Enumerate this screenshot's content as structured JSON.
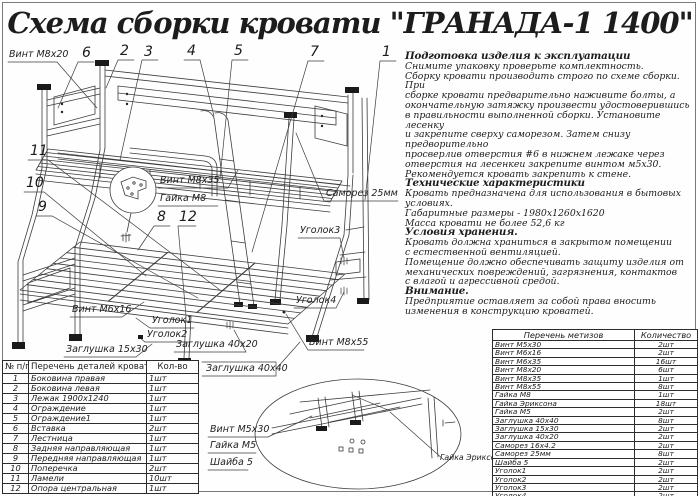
{
  "title": "Схема сборки кровати \"ГРАНАДА-1 1400\"",
  "instructions": {
    "items": [
      {
        "style": "h",
        "text": "Подготовка изделия к эксплуатации"
      },
      {
        "style": "p",
        "text": "Снимите упаковку проверьте комплектность."
      },
      {
        "style": "p",
        "text": "Сборку кровати производить строго по схеме сборки. При"
      },
      {
        "style": "p",
        "text": "сборке кровати  предварительно наживите  болты, а"
      },
      {
        "style": "p",
        "text": "окончательную затяжку произвести удостоверившись"
      },
      {
        "style": "p",
        "text": "в правильности выполненной сборки. Установите лесенку"
      },
      {
        "style": "p",
        "text": "и закрепите сверху саморезом. Затем снизу предворительно"
      },
      {
        "style": "p",
        "text": "просверлив отверстия #6 в нижнем лежаке через"
      },
      {
        "style": "p",
        "text": "отверстия на лесенкеи закрепите винтом м5х30."
      },
      {
        "style": "p",
        "text": "Рекомендуется кровать закрепить к стене."
      },
      {
        "style": "h",
        "text": "Технические характеристики"
      },
      {
        "style": "p",
        "text": "Кровать предназначена для использования в бытовых"
      },
      {
        "style": "p",
        "text": "условиях."
      },
      {
        "style": "p",
        "text": "Габаритные размеры - 1980х1260х1620"
      },
      {
        "style": "p",
        "text": "Масса кровати не более 52,6 кг"
      },
      {
        "style": "h",
        "text": "Условия хранения."
      },
      {
        "style": "p",
        "text": "Кровать должна храниться в закрытом помещении"
      },
      {
        "style": "p",
        "text": "с естественной вентиляцией."
      },
      {
        "style": "p",
        "text": "Помещение должно обеспечивать защиту изделия от"
      },
      {
        "style": "p",
        "text": "механических повреждений, загрязнения, контактов"
      },
      {
        "style": "p",
        "text": "с влагой и агрессивной средой."
      },
      {
        "style": "h",
        "text": "Внимание."
      },
      {
        "style": "p",
        "text": "Предприятие оставляет за собой права вносить"
      },
      {
        "style": "p",
        "text": "изменения в конструкцию кроватей."
      }
    ]
  },
  "diagram": {
    "labels": {
      "vint_m8x20": "Винт М8х20",
      "vint_m8x35": "Винт М8х35",
      "gaika_m8": "Гайка М8",
      "samorez_25": "Саморез 25мм",
      "ugolok3": "Уголок3",
      "ugolok4": "Уголок4",
      "vint_m8x55": "Винт М8х55",
      "vint_m6x16": "Винт М6х16",
      "ugolok1": "Уголок1",
      "ugolok2": "Уголок2",
      "zaglushka_15x30": "Заглушка 15х30",
      "zaglushka_40x20": "Заглушка 40х20",
      "zaglushka_40x40": "Заглушка 40х40",
      "vint_m5x30": "Винт М5х30",
      "gaika_m5": "Гайка М5",
      "shaiba_5": "Шайба 5",
      "gaika_eriksona": "Гайка Эриксона"
    },
    "callouts": {
      "c1": "1",
      "c2": "2",
      "c3": "3",
      "c4": "4",
      "c5": "5",
      "c6": "6",
      "c7": "7",
      "c8": "8",
      "c9": "9",
      "c10": "10",
      "c11": "11",
      "c12": "12"
    }
  },
  "parts_table": {
    "headers": {
      "num": "№ п/п",
      "name": "Перечень деталей кровати",
      "qty": "Кол-во"
    },
    "rows": [
      {
        "num": "1",
        "name": "Боковина правая",
        "qty": "1шт"
      },
      {
        "num": "2",
        "name": "Боковина левая",
        "qty": "1шт"
      },
      {
        "num": "3",
        "name": "Лежак 1900х1240",
        "qty": "1шт"
      },
      {
        "num": "4",
        "name": "Ограждение",
        "qty": "1шт"
      },
      {
        "num": "5",
        "name": "Ограждение1",
        "qty": "1шт"
      },
      {
        "num": "6",
        "name": "Вставка",
        "qty": "2шт"
      },
      {
        "num": "7",
        "name": "Лестница",
        "qty": "1шт"
      },
      {
        "num": "8",
        "name": "Задняя направляющая",
        "qty": "1шт"
      },
      {
        "num": "9",
        "name": "Передняя направляющая",
        "qty": "1шт"
      },
      {
        "num": "10",
        "name": "Поперечка",
        "qty": "2шт"
      },
      {
        "num": "11",
        "name": "Ламели",
        "qty": "10шт"
      },
      {
        "num": "12",
        "name": "Опора центральная",
        "qty": "1шт"
      }
    ]
  },
  "hardware_table": {
    "headers": {
      "name": "Перечень метизов",
      "qty": "Количество"
    },
    "rows": [
      {
        "name": "Винт М5х30",
        "qty": "2шт"
      },
      {
        "name": "Винт М6х16",
        "qty": "2шт"
      },
      {
        "name": "Винт М6х35",
        "qty": "16шт"
      },
      {
        "name": "Винт М8х20",
        "qty": "6шт"
      },
      {
        "name": "Винт М8х35",
        "qty": "1шт"
      },
      {
        "name": "Винт М8х55",
        "qty": "8шт"
      },
      {
        "name": "Гайка М8",
        "qty": "1шт"
      },
      {
        "name": "Гайка Эриксона",
        "qty": "18шт"
      },
      {
        "name": "Гайка М5",
        "qty": "2шт"
      },
      {
        "name": "Заглушка 40х40",
        "qty": "8шт"
      },
      {
        "name": "Заглушка 15х30",
        "qty": "2шт"
      },
      {
        "name": "Заглушка 40х20",
        "qty": "2шт"
      },
      {
        "name": "Саморез 16х4.2",
        "qty": "2шт"
      },
      {
        "name": "Саморез 25мм",
        "qty": "8шт"
      },
      {
        "name": "Шайба 5",
        "qty": "2шт"
      },
      {
        "name": "Уголок1",
        "qty": "2шт"
      },
      {
        "name": "Уголок2",
        "qty": "2шт"
      },
      {
        "name": "Уголок3",
        "qty": "2шт"
      },
      {
        "name": "Уголок4",
        "qty": "2шт"
      }
    ]
  }
}
